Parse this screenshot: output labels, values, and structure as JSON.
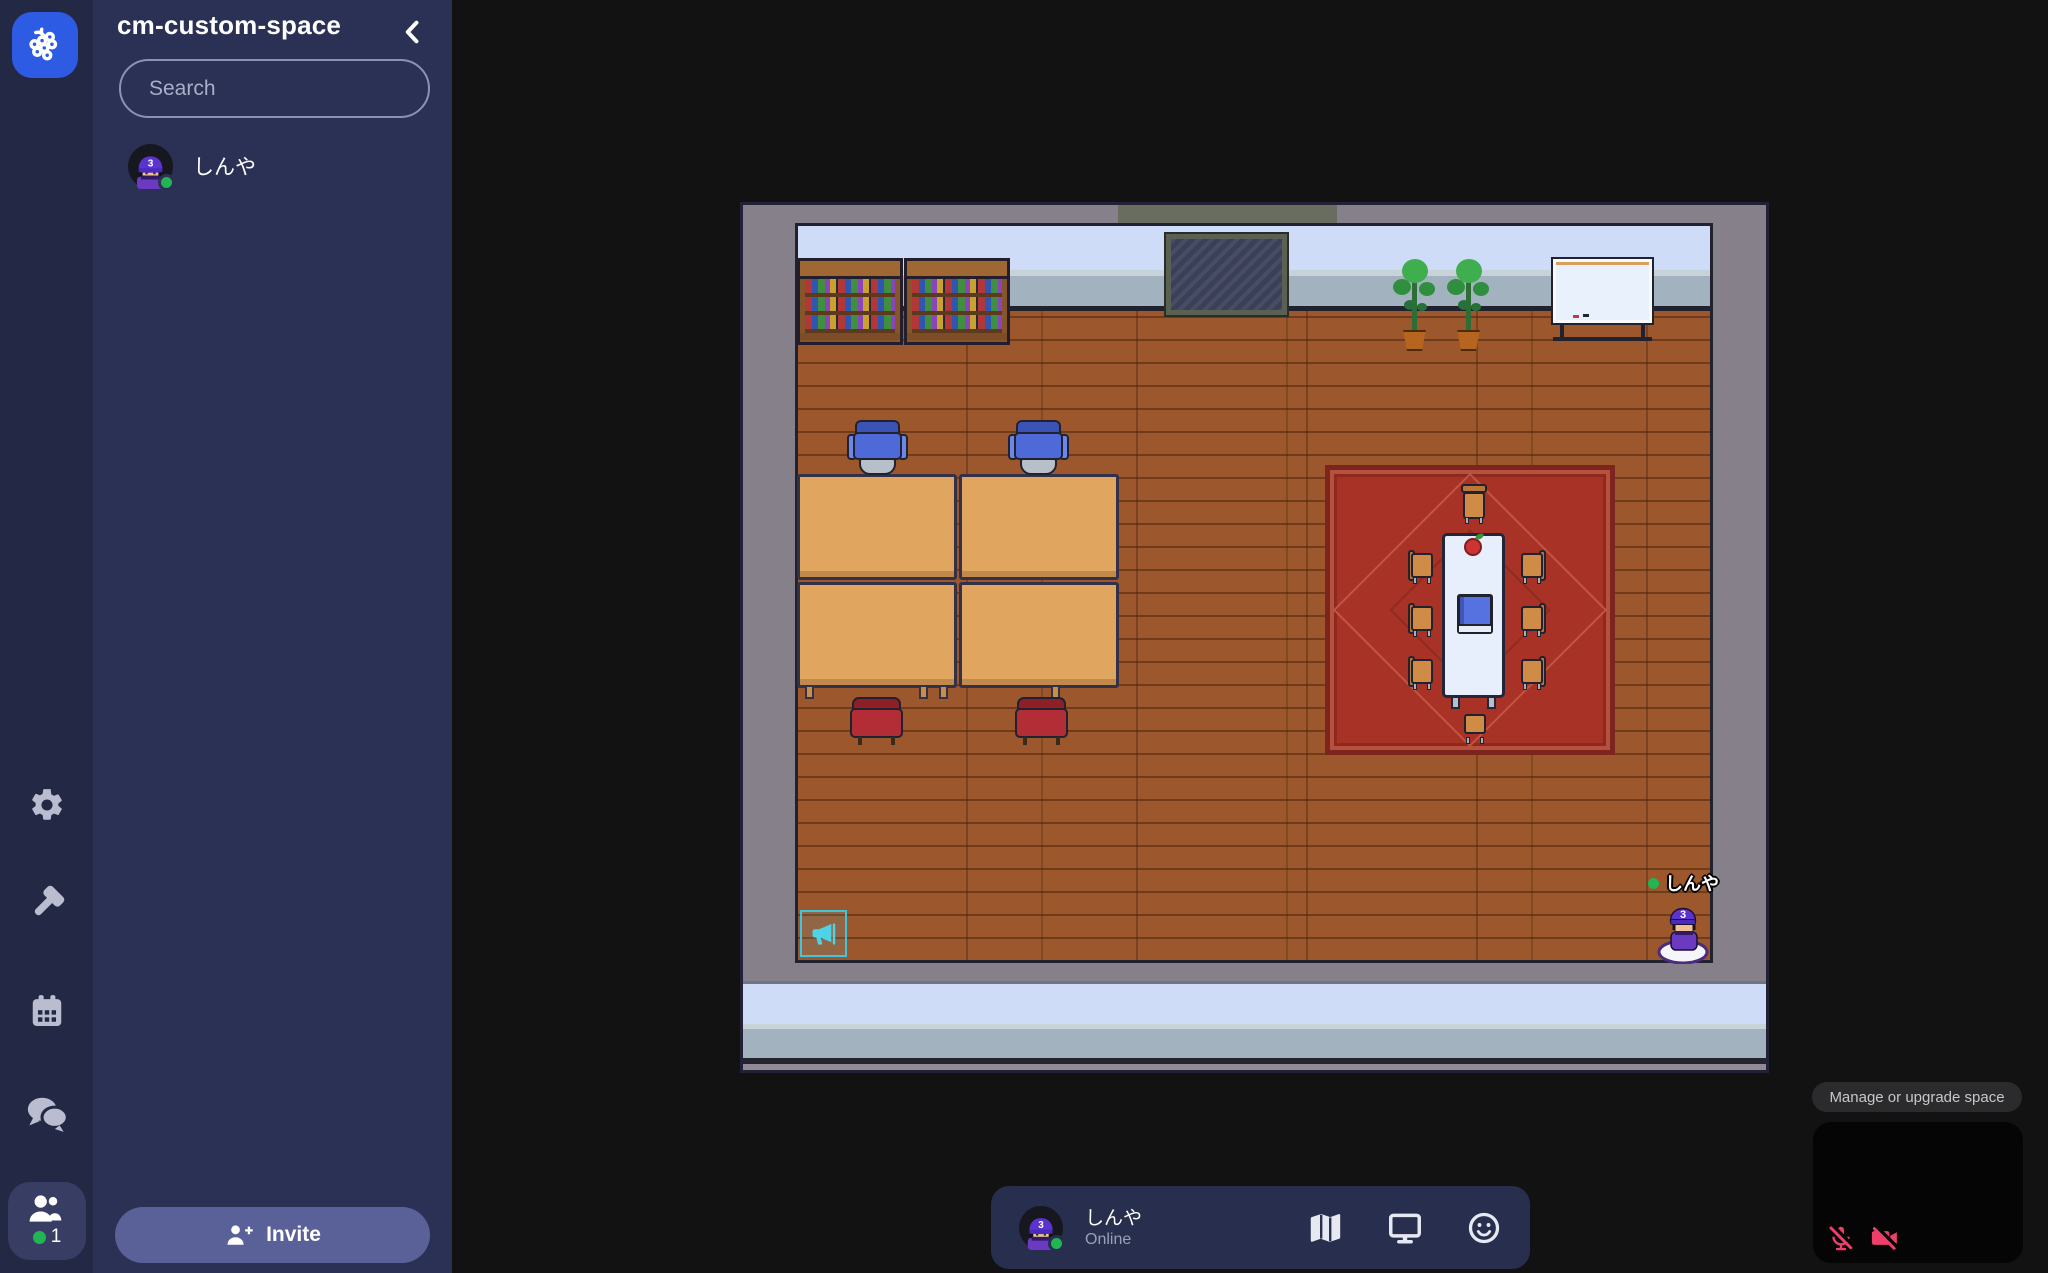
{
  "sidebar": {
    "title": "cm-custom-space",
    "search": {
      "placeholder": "Search"
    },
    "participants": [
      {
        "name": "しんや",
        "status": "online",
        "cap_badge": "3"
      }
    ],
    "invite_label": "Invite"
  },
  "rail": {
    "online_count": "1"
  },
  "control_bar": {
    "user_name": "しんや",
    "user_status": "Online",
    "cap_badge": "3"
  },
  "overlay": {
    "manage_label": "Manage or upgrade space"
  },
  "game": {
    "player_name": "しんや",
    "cap_badge": "3"
  },
  "icons": {
    "rail": [
      "gather-logo",
      "settings",
      "build",
      "calendar",
      "chat",
      "participants"
    ],
    "sidebar": [
      "search",
      "chevron-left",
      "person-plus"
    ],
    "control_bar": [
      "map",
      "screen-share",
      "emote"
    ],
    "video_preview": [
      "mic-off",
      "camera-off"
    ],
    "canvas": [
      "megaphone"
    ]
  },
  "colors": {
    "logo_blue": "#2d5be3",
    "online_green": "#23b453",
    "danger_pink": "#ee3e69",
    "spawn_cyan": "#4fd2e6",
    "rail_bg": "#232845",
    "sidebar_panel": "#2b3154",
    "invite_button": "#5a6198",
    "canvas_wall": "#85808a",
    "floor_wood": "#9d572c",
    "rug_red": "#a93227"
  }
}
